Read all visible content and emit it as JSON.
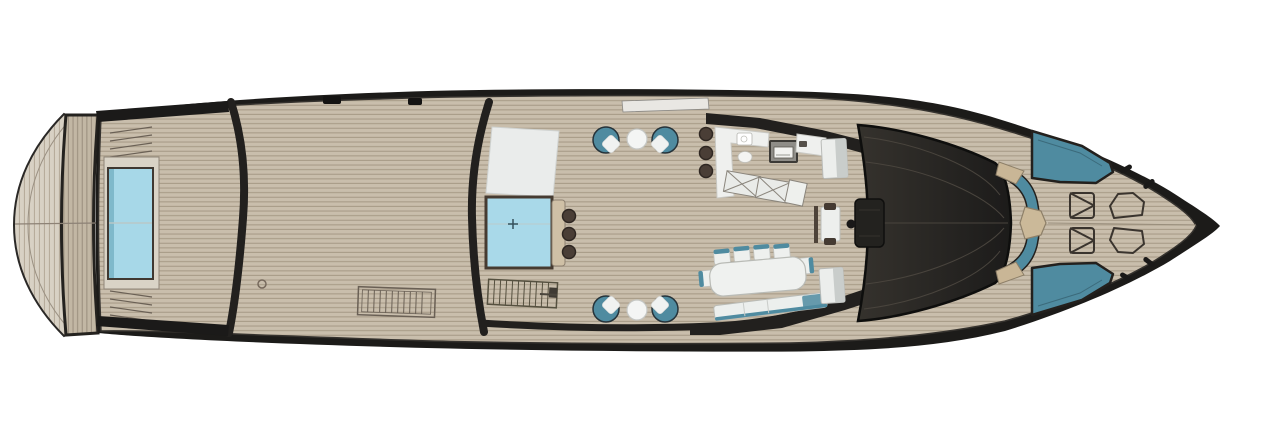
{
  "meta": {
    "title": "Motor yacht main deck plan — top view",
    "orientation": "bow to the right, stern to the left",
    "canvas": {
      "width": 1272,
      "height": 433
    }
  },
  "palette": {
    "background": "#ffffff",
    "hull": "#1c1b19",
    "rim_dark": "#22201e",
    "superstructure_a": "#35322d",
    "superstructure_b": "#1c1b1a",
    "panel_line": "#49443d",
    "deck_plank": "#c9beac",
    "deck_plank_line": "#a89c88",
    "transom_plank": "#c2b7a4",
    "transom_plank_line": "#9d9180",
    "platform_plank": "#d8d1c4",
    "platform_plank_line": "#b7ac9b",
    "pool_water": "#a7d8e8",
    "pool_water_edge": "#7fb9cb",
    "pool_surround": "#d9d3c6",
    "spa_water": "#a9d9e9",
    "sunpad_white": "#eaeceb",
    "counter_white": "#eff0ee",
    "counter_tan": "#cfc0a6",
    "stool_brown": "#4a3e36",
    "furniture_teal": "#4f8ba0",
    "cushion_white": "#f0f2f1",
    "trim_beige": "#c9b696",
    "table_tan": "#cbb999",
    "grating_line": "#6a6055",
    "hatch_outline": "#3a342e",
    "gate_white": "#e9e7e3",
    "steel_gray": "#c9cdcb",
    "seat_dark": "#443a32"
  },
  "areas": {
    "swim_platform": "swim platform with transom steps (port and starboard)",
    "aft_deck": "aft deck with rectangular pool and deck grating",
    "midship": "spa pool with swim-up bar, sun pad and two chair-and-table lounge sets",
    "cockpit": "wet bar with sink and grill, folding loungers, dining area, companionway stairs",
    "superstructure": "dark glass coach roof with forward observation table",
    "foredeck": "bow lounge sofa with table, two sun pads, hatches and mooring cleats"
  },
  "furniture": {
    "aft_pool": {
      "type": "pool",
      "shape": "rectangle"
    },
    "spa_pool": {
      "type": "jacuzzi",
      "marker": "+",
      "bar_stools": 3
    },
    "midship_sunpad": 1,
    "lounge_sets": {
      "sets": 2,
      "chairs_per_set": 2,
      "cocktail_table_per_set": 1
    },
    "wet_bar": {
      "bar_stools": 3,
      "sink": 1,
      "grill": 1,
      "cabinet": 1,
      "folding_loungers": 3
    },
    "dining": {
      "table": 1,
      "side_chairs": 4,
      "end_chairs": 2,
      "bench": 1,
      "cabinet": 1
    },
    "observation_table": {
      "tables": 1,
      "seats": 2
    },
    "bow_lounge": {
      "sofa": 1,
      "hex_table": 1,
      "sun_pads": 2
    },
    "deck_fittings": {
      "square_hatches": 2,
      "shaped_hatches": 2,
      "cleats": 4,
      "gratings": 1,
      "companionway_stairs": 1,
      "transom_step_sets": 2,
      "boarding_gate": 1
    }
  }
}
